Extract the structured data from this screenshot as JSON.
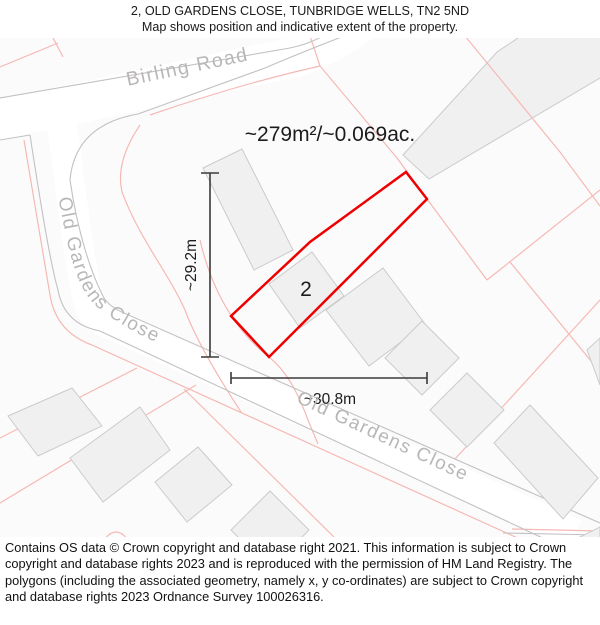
{
  "header": {
    "line1": "2, OLD GARDENS CLOSE, TUNBRIDGE WELLS, TN2 5ND",
    "line2": "Map shows position and indicative extent of the property."
  },
  "map": {
    "area_label": "~279m²/~0.069ac.",
    "plot_number": "2",
    "dim_vertical_label": "~29.2m",
    "dim_horizontal_label": "~30.8m",
    "roads": {
      "birling": "Birling Road",
      "old_gardens_upper": "Old Gardens Close",
      "old_gardens_lower": "Old Gardens Close"
    },
    "colors": {
      "plot_outline": "#ee0000",
      "parcel_line": "#f5b9b4",
      "road_line": "#c3c1c1",
      "road_text": "#b9b6b6",
      "building_fill": "#f1f0f0",
      "building_stroke": "#cbcbcb",
      "dimension": "#3a3a3a",
      "label_text": "#1c1c1c"
    }
  },
  "footer": {
    "text": "Contains OS data © Crown copyright and database right 2021. This information is subject to Crown copyright and database rights 2023 and is reproduced with the permission of HM Land Registry. The polygons (including the associated geometry, namely x, y co-ordinates) are subject to Crown copyright and database rights 2023 Ordnance Survey 100026316."
  }
}
